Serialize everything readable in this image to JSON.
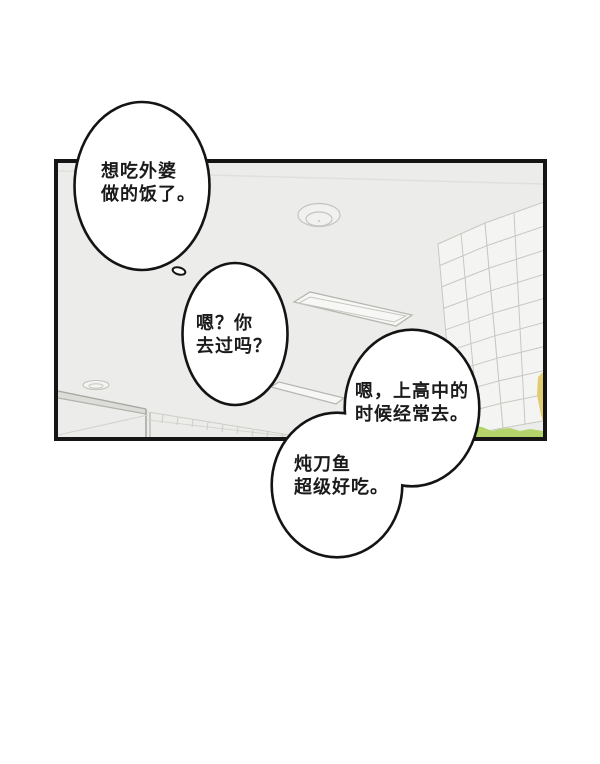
{
  "page": {
    "kind": "comic-panel",
    "background_color": "#ffffff"
  },
  "panel": {
    "background_color": "#ECECEA",
    "border_color": "#151515",
    "scene": "interior ceiling seen from below, window with high-rise building, grass and foliage at lower right"
  },
  "colors": {
    "bubble_fill": "#ffffff",
    "bubble_stroke": "#141414",
    "scene_line": "#c6c6c0",
    "grass_green": "#b5d36b",
    "foliage_yellow": "#e2cc72",
    "text": "#1b1b1b"
  },
  "bubbles": [
    {
      "id": "bubble-1",
      "line1": "想吃外婆",
      "line2": "做的饭了。"
    },
    {
      "id": "bubble-2",
      "line1": "嗯？你",
      "line2": "去过吗？"
    },
    {
      "id": "bubble-3",
      "line1": "嗯，上高中的",
      "line2": "时候经常去。"
    },
    {
      "id": "bubble-4",
      "line1": "炖刀鱼",
      "line2": "超级好吃。"
    }
  ]
}
